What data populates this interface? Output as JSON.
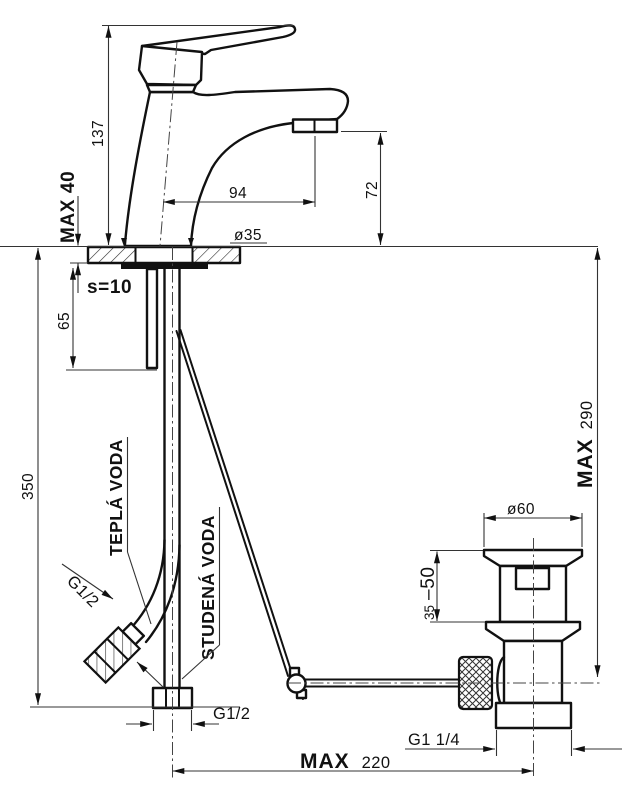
{
  "meta": {
    "type": "technical-dimension-drawing",
    "subject": "single-lever basin mixer faucet with pop-up drain"
  },
  "colors": {
    "background": "#ffffff",
    "object_line": "#111111",
    "thin_line": "#333333"
  },
  "dims": {
    "faucet_height": "137",
    "deck_max_thickness": "MAX 40",
    "deck_thickness": "s=10",
    "shank_length": "65",
    "supply_drop": "350",
    "spout_reach": "94",
    "aerator_height": "72",
    "hole_diameter": "ø35",
    "drain_top_diameter": "ø60",
    "drain_range_min": "35",
    "drain_range_max": "–50",
    "max290_label": "MAX",
    "max290_value": "290",
    "max220_label": "MAX",
    "max220_value": "220",
    "hot_hose_thread": "G1/2",
    "bottom_hose_thread": "G1/2",
    "drain_thread": "G1 1/4"
  },
  "labels": {
    "hot_water": "TEPLÁ VODA",
    "cold_water": "STUDENÁ VODA"
  }
}
